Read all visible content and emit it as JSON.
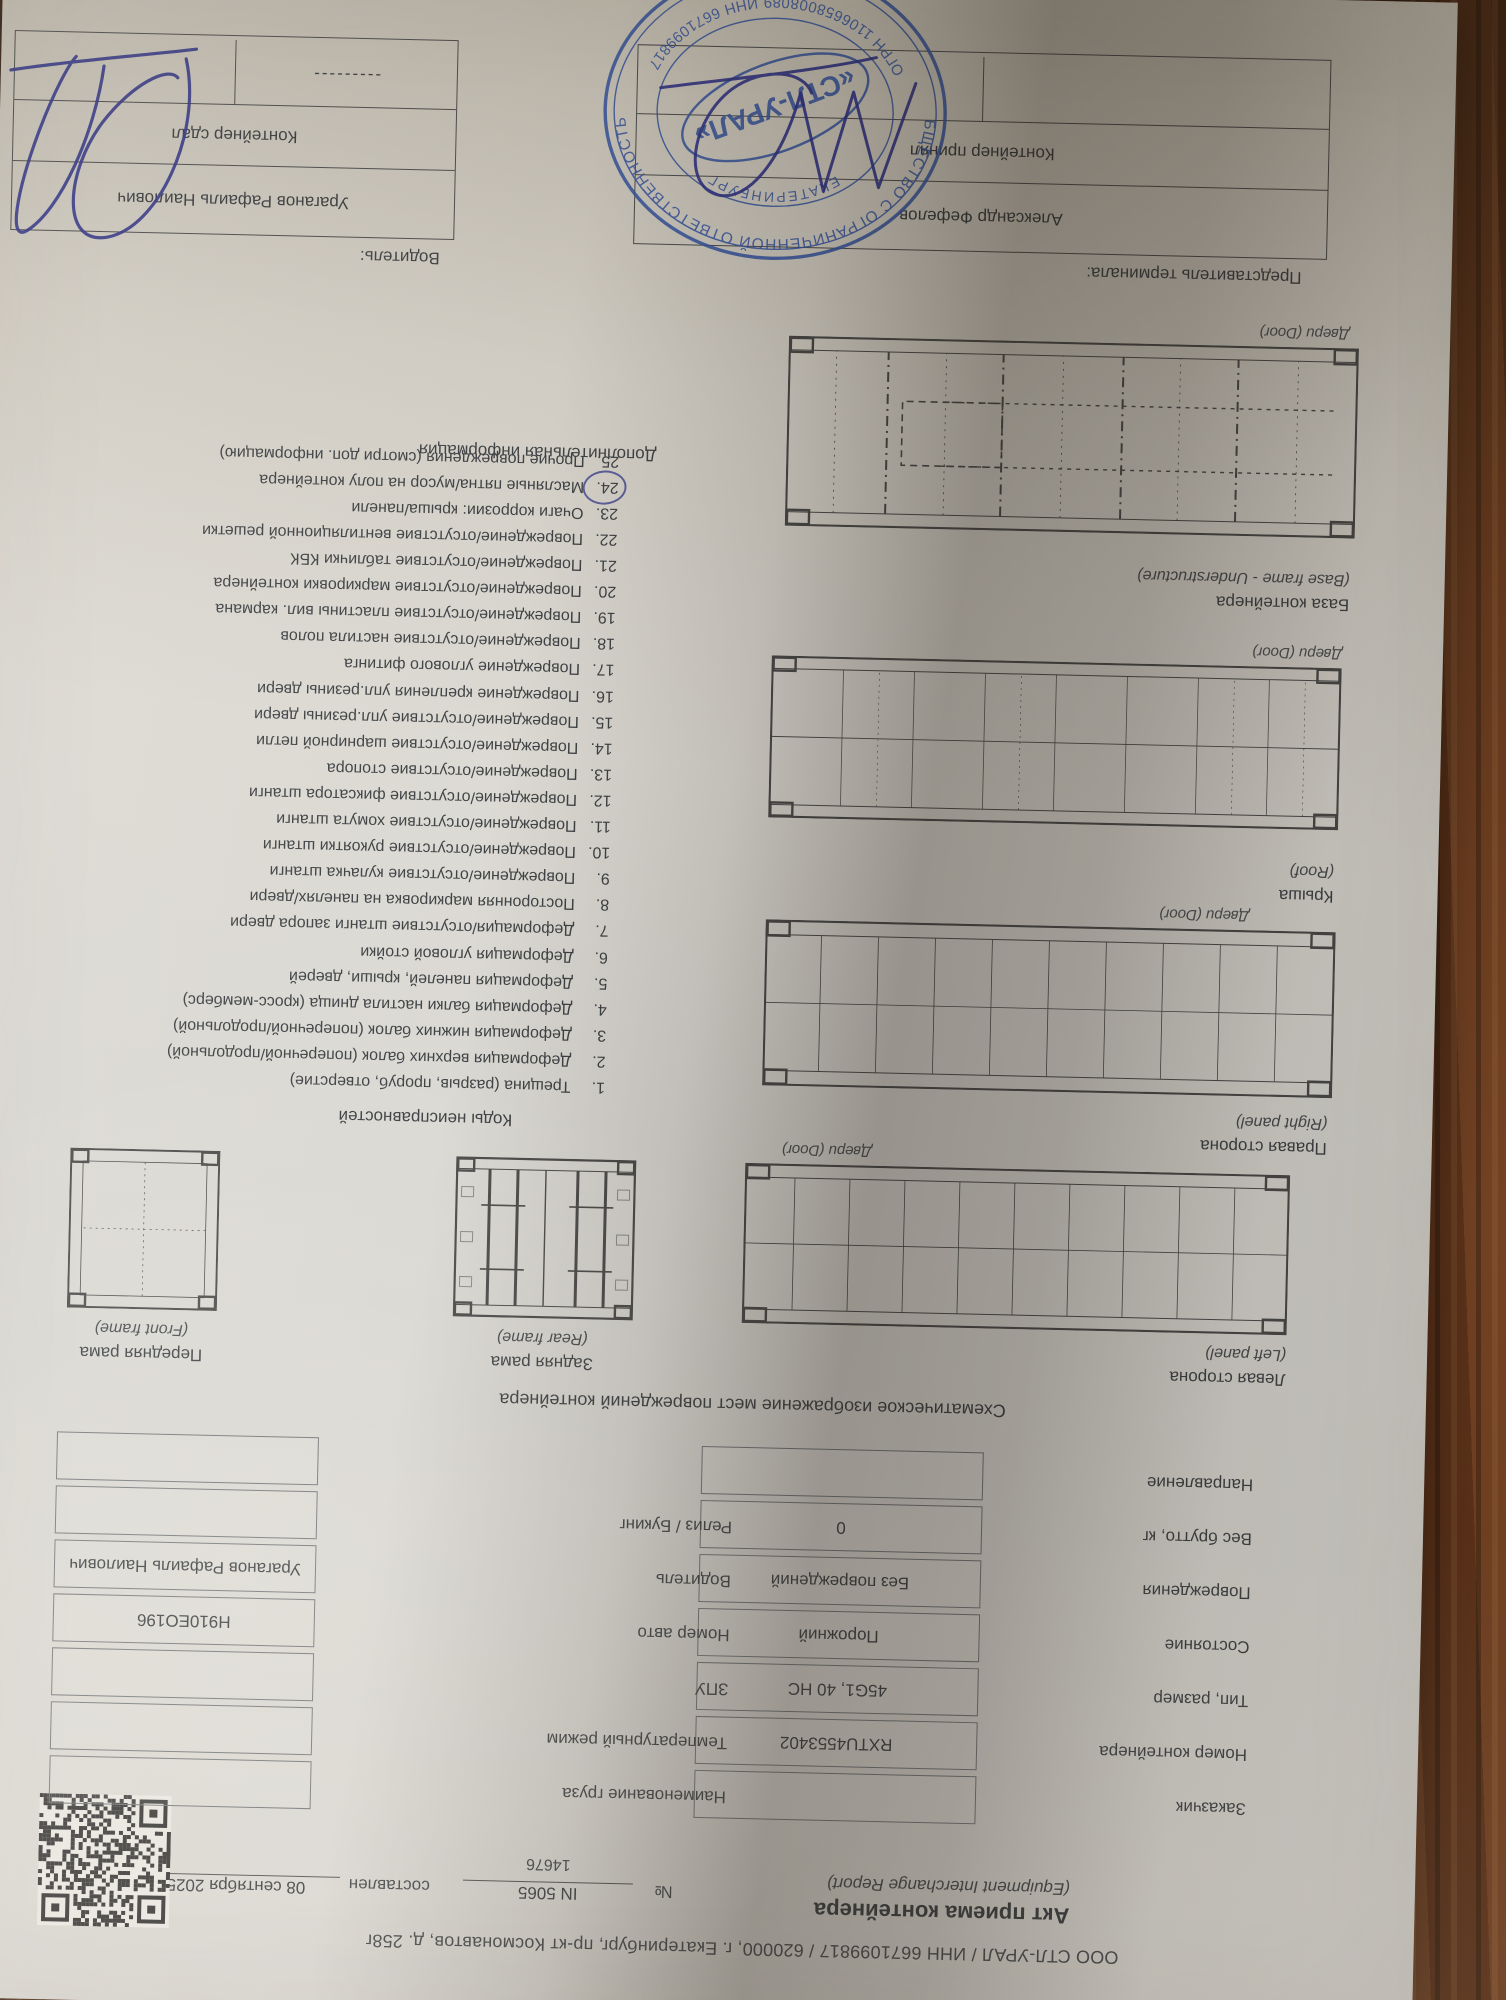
{
  "header": {
    "company_line": "ООО СТЛ-УРАЛ / ИНН 6671099817 / 620000, г. Екатеринбург, пр-кт Космонавтов, д. 258г",
    "title": "Акт приема контейнера",
    "title_en": "(Equipment Interchange Report)",
    "number_label": "№",
    "number_value": "IN 5065",
    "number_sub": "14676",
    "composed_label": "составлен",
    "composed_value": "08 сентября 2025 18:19"
  },
  "fields": {
    "rows": [
      {
        "l1": "Заказчик",
        "v1": "",
        "l2": "Наименование груза",
        "v2": ""
      },
      {
        "l1": "Номер контейнера",
        "v1": "RXTU4553402",
        "l2": "Температурный режим",
        "v2": ""
      },
      {
        "l1": "Тип, размер",
        "v1": "45G1, 40 HC",
        "l2": "ЗПУ",
        "v2": ""
      },
      {
        "l1": "Состояние",
        "v1": "Порожний",
        "l2": "Номер авто",
        "v2": "Н910ЕО196"
      },
      {
        "l1": "Повреждения",
        "v1": "Без повреждений",
        "l2": "Водитель",
        "v2": "Ураганов Рафаиль Наилович"
      },
      {
        "l1": "Вес брутто, кг",
        "v1": "0",
        "l2": "Релиз / Букинг",
        "v2": ""
      },
      {
        "l1": "Направление",
        "v1": "",
        "l2": "",
        "v2": ""
      }
    ]
  },
  "schematic": {
    "heading": "Схематическое изображение мест повреждений контейнера",
    "left_panel_title": "Левая сторона",
    "left_panel_sub": "(Left panel)",
    "rear_frame_title": "Задняя рама",
    "rear_frame_sub": "(Rear frame)",
    "front_frame_title": "Передняя рама",
    "front_frame_sub": "(Front frame)",
    "right_panel_title": "Правая сторона",
    "right_panel_sub": "(Right panel)",
    "roof_title": "Крыша",
    "roof_sub": "(Roof)",
    "base_title": "База контейнера",
    "base_sub": "(Base frame - Understructure)",
    "door_label": "Двери (Door)",
    "additional_info": "Дополнительная информация"
  },
  "codes": {
    "heading": "Коды неисправностей",
    "circled_number": 24,
    "items": [
      "Трещина (разрыв, проруб, отверстие)",
      "Деформация верхних балок (поперечной/продольной)",
      "Деформация нижних балок (поперечной/продольной)",
      "Деформация балки настила днища (кросс-мемберс)",
      "Деформация панелей, крыши, дверей",
      "Деформация угловой стойки",
      "Деформация/отсутствие штанги запора двери",
      "Посторонняя маркировка на панелях/двери",
      "Повреждение/отсутствие кулачка штанги",
      "Повреждение/отсутствие рукоятки штанги",
      "Повреждение/отсутствие хомута штанги",
      "Повреждение/отсутствие фиксатора штанги",
      "Повреждение/отсутствие стопора",
      "Повреждение/отсутствие шарнирной петли",
      "Повреждение/отсутствие упл.резины двери",
      "Повреждение крепления упл.резины двери",
      "Повреждение углового фитинга",
      "Повреждение/отсутствие настила полов",
      "Повреждение/отсутствие пластины вил. кармана",
      "Повреждение/отсутствие маркировки контейнера",
      "Повреждение/отсутствие таблички КБК",
      "Повреждение/отсутствие вентиляционной решетки",
      "Очаги коррозии: крыша/панели",
      "Масляные пятна/мусор на полу контейнера",
      "Прочие повреждения (смотри доп. информацию)"
    ]
  },
  "signatures": {
    "left_header": "Представитель терминала:",
    "left_name": "Александр Фефелов",
    "left_action": "Контейнер принял",
    "right_header": "Водитель:",
    "right_name": "Ураганов Рафаиль Наилович",
    "right_action": "Контейнер сдал",
    "right_bottom": "---------"
  },
  "stamp": {
    "ring_top": "ОБЩЕСТВО С ОГРАНИЧЕННОЙ ОТВЕТСТВЕННОСТЬЮ",
    "ring_bottom": "ОГРН 1106658008089  ИНН 6671099817",
    "city": "ЕКАТЕРИНБУРГ",
    "name": "«СТЛ-УРАЛ»",
    "ink_color": "#3355a8"
  }
}
